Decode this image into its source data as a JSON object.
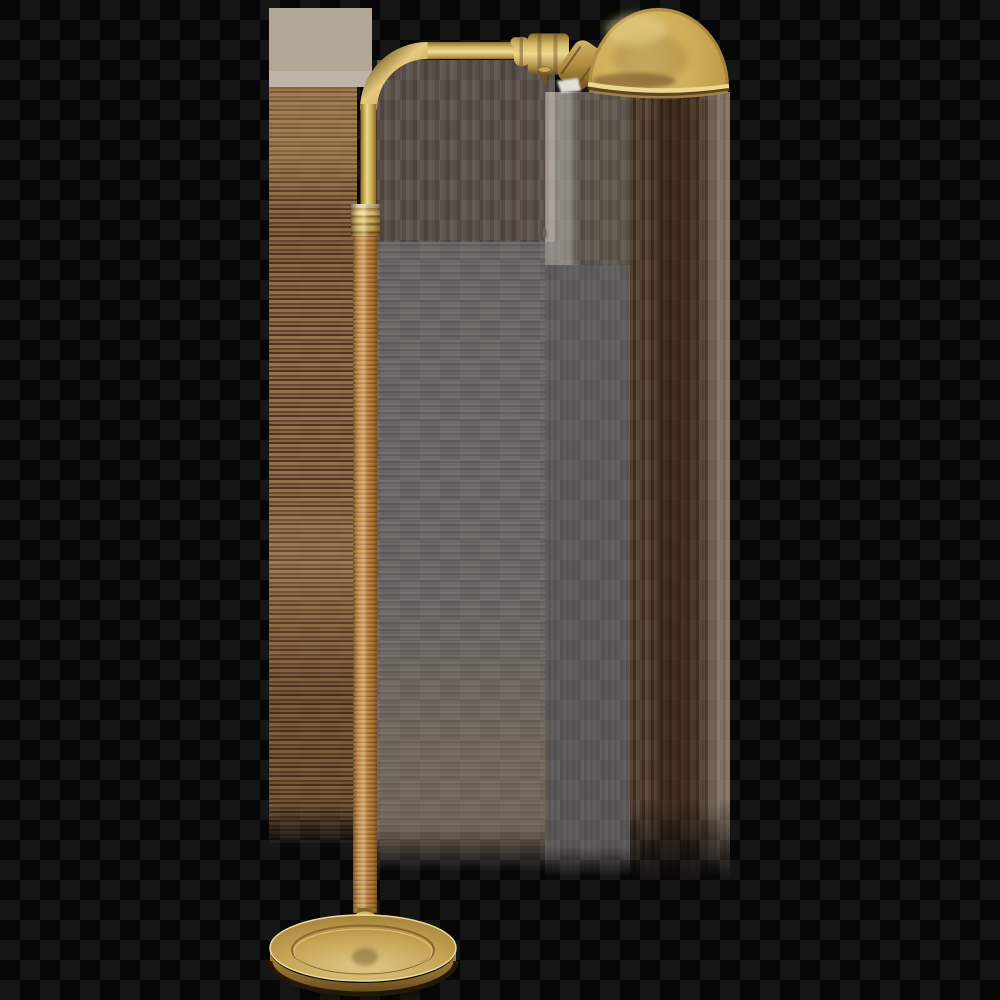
{
  "image": {
    "subject": "Antique hand-rubbed brass pharmacy floor lamp with dome shade, pull chain, rattan-wrapped column and round brass base on a transparent checkered background",
    "background": "dark transparency checkerboard with color-smear artifact bands",
    "parts": {
      "dome_shade": "brass half-dome shade facing down-left",
      "socket": "ribbed brass socket barrel with swivel knuckle",
      "pull_chain": "small brass pull finial with thin hanging cord",
      "arm": "curved brass gooseneck arm",
      "collar": "ringed brass ferrule at top of column",
      "stem": "rattan-wrapped column with horizontal wraps",
      "ball_joint": "turned brass urn connector above base",
      "base": "round stepped brass base with engraved ring groove"
    }
  },
  "colors": {
    "checker_dark": "#070707",
    "checker_light": "#161616",
    "gray_patch": "#b2a695",
    "brass_highlight": "#ecd894",
    "brass_mid": "#c9a850",
    "brass_dark": "#8a6a2e",
    "brass_deep": "#5e451c",
    "rattan_light": "#daa55e",
    "rattan_mid": "#c58845",
    "rattan_dark": "#8a5a28",
    "smear_brown": "#a3784e",
    "smear_gray": "#c6c2be",
    "smear_tan": "#c8ab8e",
    "cord_gray": "#57504a"
  }
}
